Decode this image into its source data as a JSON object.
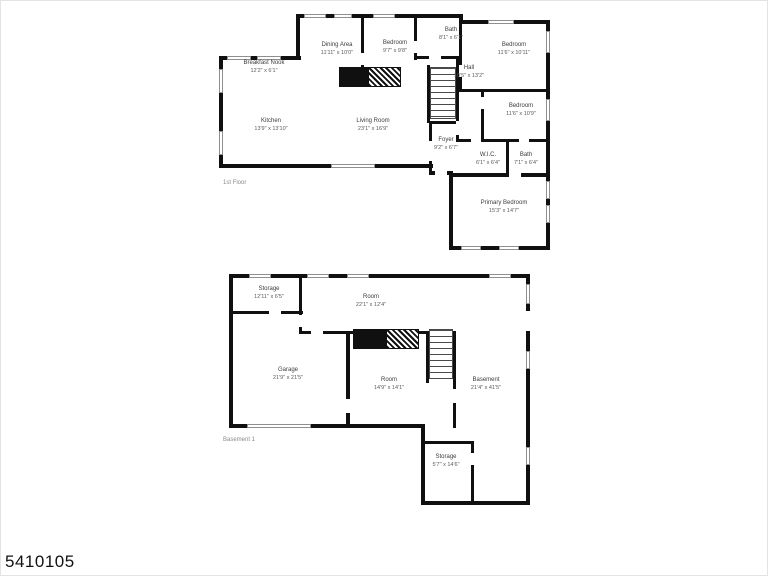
{
  "page": {
    "listing_id": "5410105"
  },
  "floors": [
    {
      "title": "1st Floor",
      "rooms": [
        {
          "name": "Breakfast Nook",
          "dims": "12'2\" x 6'1\""
        },
        {
          "name": "Dining Area",
          "dims": "11'11\" x 10'0\""
        },
        {
          "name": "Bedroom",
          "dims": "9'7\" x 9'8\""
        },
        {
          "name": "Bath",
          "dims": "8'1\" x 6'1\""
        },
        {
          "name": "Bedroom",
          "dims": "11'6\" x 10'11\""
        },
        {
          "name": "Hall",
          "dims": "10'5\" x 13'2\""
        },
        {
          "name": "Bedroom",
          "dims": "11'6\" x 10'9\""
        },
        {
          "name": "Kitchen",
          "dims": "13'9\" x 13'10\""
        },
        {
          "name": "Living Room",
          "dims": "23'1\" x 16'9\""
        },
        {
          "name": "Foyer",
          "dims": "9'2\" x 6'7\""
        },
        {
          "name": "W.I.C.",
          "dims": "6'1\" x 6'4\""
        },
        {
          "name": "Bath",
          "dims": "7'1\" x 6'4\""
        },
        {
          "name": "Primary Bedroom",
          "dims": "15'3\" x 14'7\""
        }
      ]
    },
    {
      "title": "Basement 1",
      "rooms": [
        {
          "name": "Storage",
          "dims": "12'11\" x 6'5\""
        },
        {
          "name": "Room",
          "dims": "22'1\" x 12'4\""
        },
        {
          "name": "Garage",
          "dims": "21'9\" x 21'5\""
        },
        {
          "name": "Room",
          "dims": "14'9\" x 14'1\""
        },
        {
          "name": "Basement",
          "dims": "21'4\" x 41'5\""
        },
        {
          "name": "Storage",
          "dims": "5'7\" x 14'6\""
        }
      ]
    }
  ]
}
